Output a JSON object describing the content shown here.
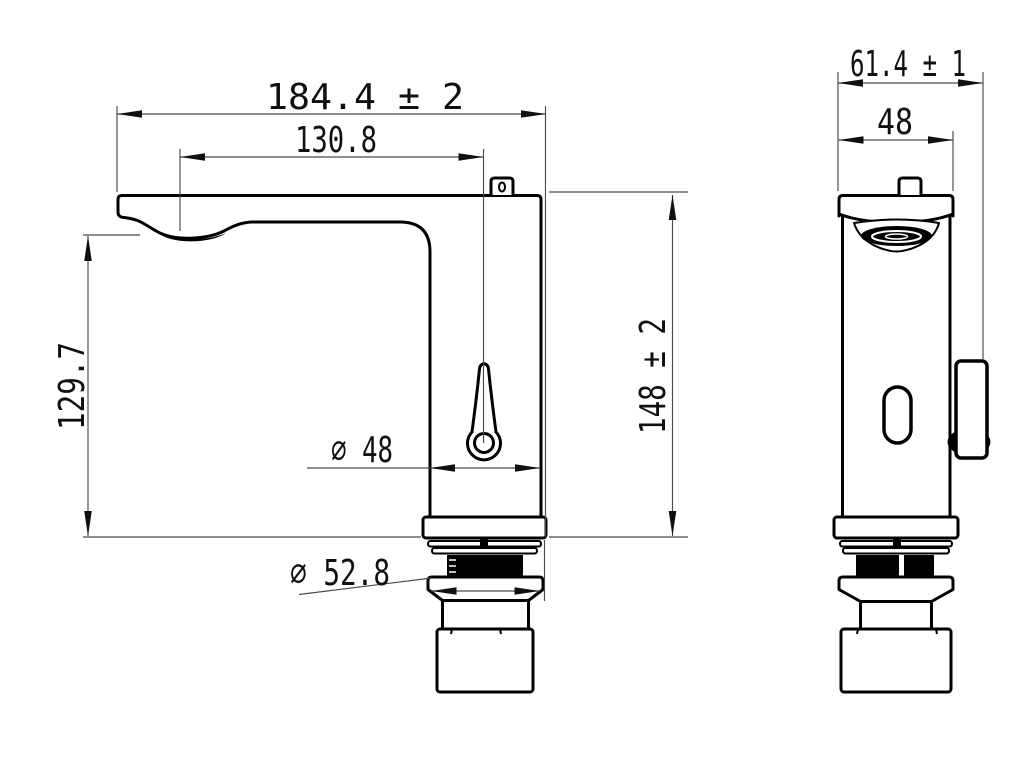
{
  "drawing": {
    "background": "#ffffff",
    "outline_color": "#000000",
    "dim_line_color": "#4a4a4a",
    "text_color": "#101010",
    "views": {
      "front": {
        "dims": {
          "overall_width": {
            "label": "184.4 ± 2"
          },
          "spout_reach": {
            "label": "130.8"
          },
          "spout_height": {
            "label": "129.7"
          },
          "overall_height": {
            "label": "148 ± 2"
          },
          "body_diameter": {
            "label": "∅ 48"
          },
          "flange_diameter": {
            "label": "∅ 52.8"
          }
        }
      },
      "side": {
        "dims": {
          "overall_depth": {
            "label": "61.4 ± 1"
          },
          "body_width": {
            "label": "48"
          }
        }
      }
    }
  }
}
